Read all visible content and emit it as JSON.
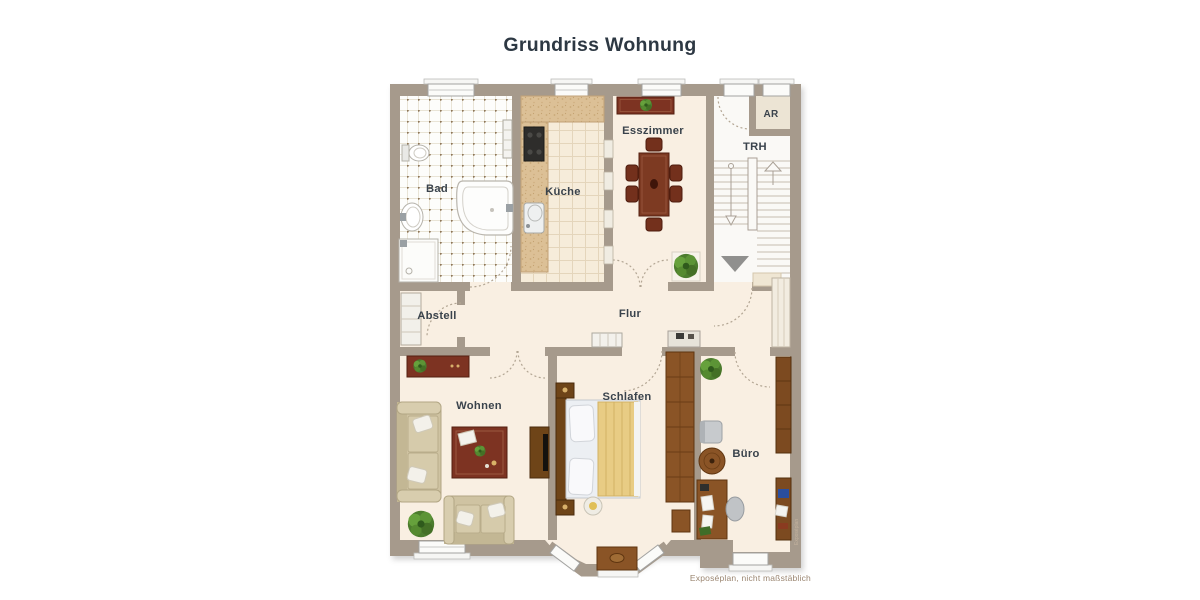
{
  "title": "Grundriss Wohnung",
  "footer": "Exposéplan, nicht maßstäblich",
  "watermark": "Exposéplan",
  "rooms": {
    "bad": {
      "label": "Bad"
    },
    "kueche": {
      "label": "Küche"
    },
    "esszimmer": {
      "label": "Esszimmer"
    },
    "ar": {
      "label": "AR"
    },
    "trh": {
      "label": "TRH"
    },
    "abstell": {
      "label": "Abstell"
    },
    "flur": {
      "label": "Flur"
    },
    "wohnen": {
      "label": "Wohnen"
    },
    "schlafen": {
      "label": "Schlafen"
    },
    "buero": {
      "label": "Büro"
    }
  },
  "colors": {
    "wall": "#a69a8c",
    "floor_cream": "#f9efe2",
    "floor_bath": "#fdfdfb",
    "floor_kitchen": "#f6ecda",
    "floor_stairwell": "#faf9f6",
    "wood": "#8a5426",
    "dark_red_furniture": "#7d3322",
    "sofa_beige": "#cfc3a2",
    "blanket_yellow": "#e8cc84",
    "plant_green": "#4c7c2e",
    "label_text": "#3a434c",
    "title_text": "#2d3843",
    "footer_text": "#9a8570"
  }
}
